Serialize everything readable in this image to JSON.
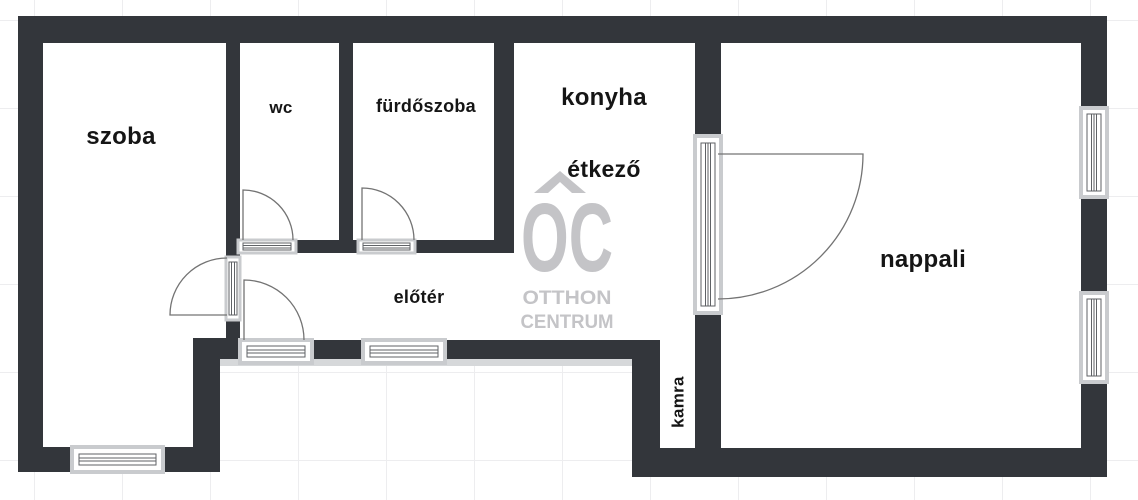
{
  "rooms": {
    "szoba": {
      "label": "szoba"
    },
    "wc": {
      "label": "wc"
    },
    "furdoszoba": {
      "label": "fürdőszoba"
    },
    "konyha": {
      "label": "konyha"
    },
    "etkezo": {
      "label": "étkező"
    },
    "eloter": {
      "label": "előtér"
    },
    "nappali": {
      "label": "nappali"
    },
    "kamra": {
      "label": "kamra"
    }
  },
  "watermark": {
    "initials": "OC",
    "line1": "OTTHON",
    "line2": "CENTRUM"
  },
  "icons": [
    "logo-roof-icon",
    "window-icon",
    "door-frame-icon",
    "door-swing-icon"
  ],
  "colors": {
    "wall": "#33363b",
    "label": "#151515",
    "watermark": "#c4c4c7",
    "grid": "#ededef",
    "frame": "#c9cbce",
    "symline": "#5f6266",
    "swing": "#737373",
    "sill": "#d6d8da"
  }
}
